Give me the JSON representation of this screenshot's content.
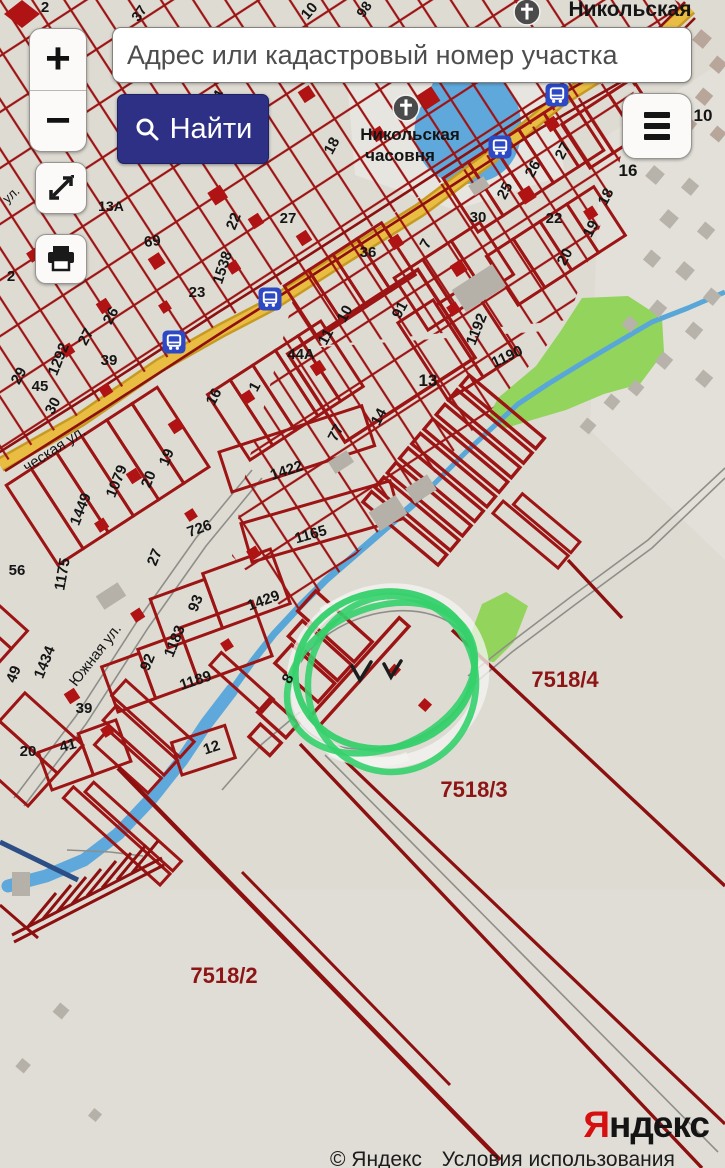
{
  "ui": {
    "zoom_in_label": "+",
    "zoom_out_label": "−",
    "search_placeholder": "Адрес или кадастровый номер участка",
    "find_button_label": "Найти",
    "icons": {
      "find": "search-icon",
      "menu": "hamburger-icon",
      "fullscreen": "expand-arrows-icon",
      "print": "printer-icon"
    }
  },
  "attribution": {
    "logo_first_letter": "Я",
    "logo_rest": "ндекс",
    "copyright_prefix": "© Яндекс",
    "terms_link": "Условия использования"
  },
  "map": {
    "annotation": {
      "shape": "hand-drawn green circle with white highlighter",
      "marks": "two handwritten check marks inside"
    },
    "field_labels": [
      "7518/4",
      "7518/3",
      "7518/2"
    ],
    "poi": {
      "chapels": [
        {
          "x": 527,
          "y": 12
        },
        {
          "x": 406,
          "y": 108
        }
      ],
      "bus_stops": [
        {
          "x": 557,
          "y": 95
        },
        {
          "x": 500,
          "y": 147
        },
        {
          "x": 270,
          "y": 299
        },
        {
          "x": 174,
          "y": 342
        }
      ]
    },
    "labels": [
      {
        "t": "2",
        "x": 45,
        "y": 12,
        "r": 0,
        "s": 15,
        "b": 1
      },
      {
        "t": "37",
        "x": 143,
        "y": 16,
        "r": -55,
        "s": 14,
        "b": 1
      },
      {
        "t": "10",
        "x": 313,
        "y": 14,
        "r": -50,
        "s": 15,
        "b": 1
      },
      {
        "t": "98",
        "x": 368,
        "y": 12,
        "r": -55,
        "s": 14,
        "b": 1
      },
      {
        "t": "Никольская",
        "x": 630,
        "y": 16,
        "r": 0,
        "s": 21,
        "b": 1
      },
      {
        "t": "Никольская",
        "x": 410,
        "y": 140,
        "r": 0,
        "s": 17,
        "b": 1
      },
      {
        "t": "часовня",
        "x": 400,
        "y": 161,
        "r": 0,
        "s": 17,
        "b": 1
      },
      {
        "t": "ул.",
        "x": 14,
        "y": 198,
        "r": -42,
        "s": 13
      },
      {
        "t": "94",
        "x": 221,
        "y": 101,
        "r": -62,
        "s": 15,
        "b": 1
      },
      {
        "t": "19",
        "x": 194,
        "y": 153,
        "r": -62,
        "s": 15,
        "b": 1
      },
      {
        "t": "18",
        "x": 249,
        "y": 156,
        "r": -62,
        "s": 15,
        "b": 1
      },
      {
        "t": "18",
        "x": 336,
        "y": 148,
        "r": -62,
        "s": 15,
        "b": 1
      },
      {
        "t": "13А",
        "x": 111,
        "y": 211,
        "r": 0,
        "s": 14,
        "b": 1
      },
      {
        "t": "22",
        "x": 238,
        "y": 223,
        "r": -68,
        "s": 15,
        "b": 1
      },
      {
        "t": "27",
        "x": 288,
        "y": 223,
        "r": 0,
        "s": 15,
        "b": 1
      },
      {
        "t": "69",
        "x": 153,
        "y": 246,
        "r": -8,
        "s": 15,
        "b": 1
      },
      {
        "t": "1538",
        "x": 227,
        "y": 269,
        "r": -72,
        "s": 15,
        "b": 1
      },
      {
        "t": "36",
        "x": 368,
        "y": 257,
        "r": 0,
        "s": 15,
        "b": 1
      },
      {
        "t": "23",
        "x": 197,
        "y": 297,
        "r": 0,
        "s": 15,
        "b": 1
      },
      {
        "t": "2",
        "x": 11,
        "y": 281,
        "r": 0,
        "s": 15,
        "b": 1
      },
      {
        "t": "26",
        "x": 115,
        "y": 318,
        "r": -62,
        "s": 15,
        "b": 1
      },
      {
        "t": "27",
        "x": 90,
        "y": 339,
        "r": -62,
        "s": 15,
        "b": 1
      },
      {
        "t": "1292",
        "x": 63,
        "y": 361,
        "r": -68,
        "s": 15,
        "b": 1
      },
      {
        "t": "39",
        "x": 109,
        "y": 365,
        "r": 0,
        "s": 15,
        "b": 1
      },
      {
        "t": "29",
        "x": 23,
        "y": 378,
        "r": -62,
        "s": 15,
        "b": 1
      },
      {
        "t": "45",
        "x": 40,
        "y": 391,
        "r": 0,
        "s": 15,
        "b": 1
      },
      {
        "t": "30",
        "x": 57,
        "y": 408,
        "r": -62,
        "s": 15,
        "b": 1
      },
      {
        "t": "91",
        "x": 404,
        "y": 312,
        "r": -62,
        "s": 15,
        "b": 1
      },
      {
        "t": "10",
        "x": 349,
        "y": 316,
        "r": -62,
        "s": 15,
        "b": 1
      },
      {
        "t": "11",
        "x": 330,
        "y": 339,
        "r": -62,
        "s": 15,
        "b": 1
      },
      {
        "t": "7",
        "x": 430,
        "y": 246,
        "r": -62,
        "s": 15,
        "b": 1
      },
      {
        "t": "30",
        "x": 478,
        "y": 222,
        "r": 0,
        "s": 15,
        "b": 1
      },
      {
        "t": "22",
        "x": 554,
        "y": 223,
        "r": 0,
        "s": 15,
        "b": 1
      },
      {
        "t": "25",
        "x": 509,
        "y": 193,
        "r": -62,
        "s": 15,
        "b": 1
      },
      {
        "t": "26",
        "x": 537,
        "y": 171,
        "r": -62,
        "s": 15,
        "b": 1
      },
      {
        "t": "27",
        "x": 567,
        "y": 153,
        "r": -62,
        "s": 15,
        "b": 1
      },
      {
        "t": "18",
        "x": 610,
        "y": 199,
        "r": -62,
        "s": 15,
        "b": 1
      },
      {
        "t": "19",
        "x": 595,
        "y": 231,
        "r": -62,
        "s": 15,
        "b": 1
      },
      {
        "t": "20",
        "x": 569,
        "y": 259,
        "r": -62,
        "s": 15,
        "b": 1
      },
      {
        "t": "16",
        "x": 628,
        "y": 176,
        "r": 0,
        "s": 17,
        "b": 1
      },
      {
        "t": "10",
        "x": 703,
        "y": 121,
        "r": 0,
        "s": 17,
        "b": 1
      },
      {
        "t": "1192",
        "x": 481,
        "y": 331,
        "r": -68,
        "s": 15,
        "b": 1
      },
      {
        "t": "1190",
        "x": 509,
        "y": 361,
        "r": -25,
        "s": 15,
        "b": 1
      },
      {
        "t": "44А",
        "x": 301,
        "y": 359,
        "r": 0,
        "s": 15,
        "b": 1
      },
      {
        "t": "13",
        "x": 428,
        "y": 386,
        "r": 0,
        "s": 17,
        "b": 1
      },
      {
        "t": "16",
        "x": 218,
        "y": 399,
        "r": -62,
        "s": 15,
        "b": 1
      },
      {
        "t": "1",
        "x": 259,
        "y": 389,
        "r": -62,
        "s": 15,
        "b": 1
      },
      {
        "t": "14",
        "x": 383,
        "y": 419,
        "r": -62,
        "s": 15,
        "b": 1
      },
      {
        "t": "77",
        "x": 340,
        "y": 435,
        "r": -62,
        "s": 15,
        "b": 1
      },
      {
        "t": "ческая ул.",
        "x": 57,
        "y": 453,
        "r": -33,
        "s": 15
      },
      {
        "t": "19",
        "x": 171,
        "y": 459,
        "r": -68,
        "s": 15,
        "b": 1
      },
      {
        "t": "20",
        "x": 153,
        "y": 481,
        "r": -68,
        "s": 15,
        "b": 1
      },
      {
        "t": "1079",
        "x": 121,
        "y": 483,
        "r": -68,
        "s": 15,
        "b": 1
      },
      {
        "t": "1449",
        "x": 85,
        "y": 511,
        "r": -68,
        "s": 15,
        "b": 1
      },
      {
        "t": "1422",
        "x": 288,
        "y": 475,
        "r": -18,
        "s": 15,
        "b": 1
      },
      {
        "t": "726",
        "x": 201,
        "y": 533,
        "r": -20,
        "s": 15,
        "b": 1
      },
      {
        "t": "27",
        "x": 159,
        "y": 559,
        "r": -68,
        "s": 15,
        "b": 1
      },
      {
        "t": "1165",
        "x": 312,
        "y": 539,
        "r": -16,
        "s": 15,
        "b": 1
      },
      {
        "t": "1175",
        "x": 67,
        "y": 575,
        "r": -80,
        "s": 15,
        "b": 1
      },
      {
        "t": "56",
        "x": 17,
        "y": 575,
        "r": 0,
        "s": 15,
        "b": 1
      },
      {
        "t": "93",
        "x": 200,
        "y": 605,
        "r": -68,
        "s": 15,
        "b": 1
      },
      {
        "t": "1429",
        "x": 265,
        "y": 605,
        "r": -20,
        "s": 15,
        "b": 1
      },
      {
        "t": "1183",
        "x": 179,
        "y": 643,
        "r": -68,
        "s": 15,
        "b": 1
      },
      {
        "t": "92",
        "x": 152,
        "y": 664,
        "r": -68,
        "s": 15,
        "b": 1
      },
      {
        "t": "1189",
        "x": 197,
        "y": 685,
        "r": -18,
        "s": 15,
        "b": 1
      },
      {
        "t": "Южная ул.",
        "x": 99,
        "y": 658,
        "r": -52,
        "s": 15
      },
      {
        "t": "1434",
        "x": 49,
        "y": 664,
        "r": -68,
        "s": 15,
        "b": 1
      },
      {
        "t": "49",
        "x": 18,
        "y": 676,
        "r": -68,
        "s": 15,
        "b": 1
      },
      {
        "t": "39",
        "x": 84,
        "y": 713,
        "r": 0,
        "s": 15,
        "b": 1
      },
      {
        "t": "41",
        "x": 69,
        "y": 750,
        "r": -15,
        "s": 15,
        "b": 1
      },
      {
        "t": "20",
        "x": 28,
        "y": 756,
        "r": 0,
        "s": 15,
        "b": 1
      },
      {
        "t": "12",
        "x": 213,
        "y": 752,
        "r": -18,
        "s": 15,
        "b": 1
      },
      {
        "t": "8",
        "x": 292,
        "y": 681,
        "r": -60,
        "s": 15,
        "b": 1
      },
      {
        "t": "7518/4",
        "x": 565,
        "y": 687,
        "r": 0,
        "s": 22,
        "c": "red",
        "b": 1
      },
      {
        "t": "7518/3",
        "x": 474,
        "y": 797,
        "r": 0,
        "s": 22,
        "c": "red",
        "b": 1
      },
      {
        "t": "7518/2",
        "x": 224,
        "y": 983,
        "r": 0,
        "s": 22,
        "c": "red",
        "b": 1
      }
    ]
  },
  "colors": {
    "map_bg": "#dedbd3",
    "parcel_red": "#9c1414",
    "building_red": "#b01313",
    "label_black": "#151515",
    "label_red": "#8e1515",
    "road_yellow": "#e9bc42",
    "road_casing": "#c79a22",
    "water_blue": "#5fa8dc",
    "green_area": "#93d45c",
    "annotation_green": "#35d06b",
    "ui_navy": "#2d3084",
    "bus_blue": "#2d49c4",
    "building_gray": "#b5b1a9",
    "logo_red": "#d60f0f"
  }
}
